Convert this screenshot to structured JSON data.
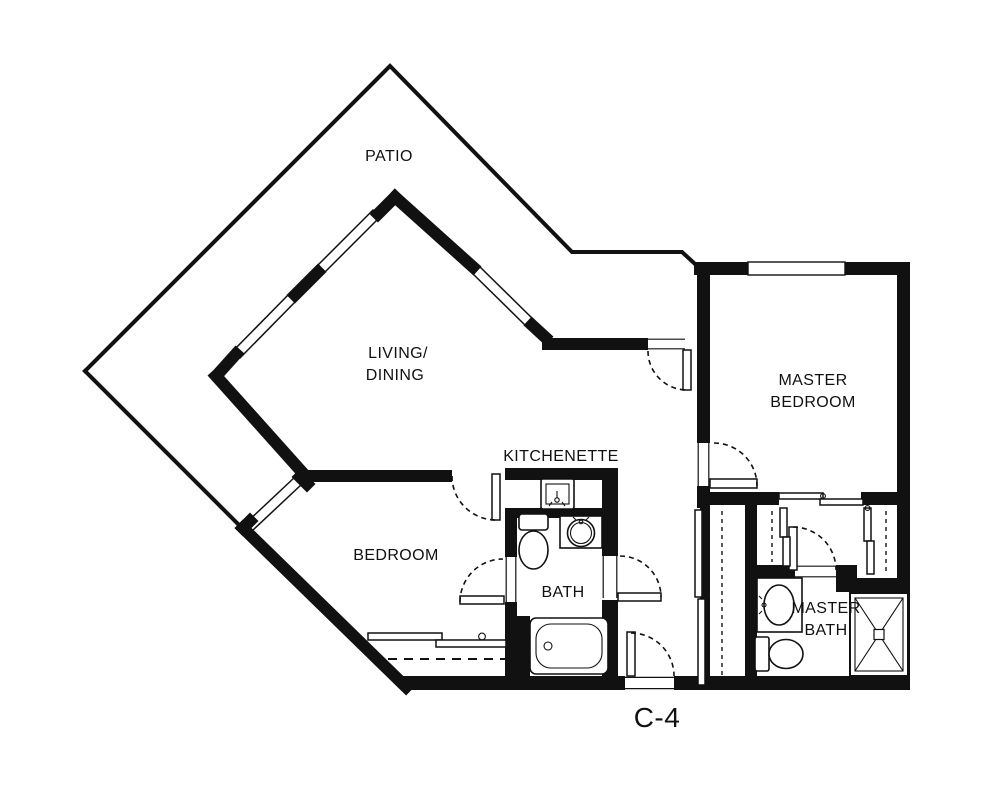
{
  "plan": {
    "code": "C-4",
    "rooms": {
      "patio": "PATIO",
      "living_line1": "LIVING/",
      "living_line2": "DINING",
      "kitchenette": "KITCHENETTE",
      "bedroom": "BEDROOM",
      "bath": "BATH",
      "master_bedroom_line1": "MASTER",
      "master_bedroom_line2": "BEDROOM",
      "master_bath_line1": "MASTER",
      "master_bath_line2": "BATH"
    },
    "colors": {
      "wall": "#111111",
      "background": "#ffffff",
      "text": "#111111"
    },
    "fixtures": [
      "kitchen-sink",
      "toilet",
      "vanity-sink",
      "bathtub",
      "master-vanity-sink",
      "master-toilet",
      "shower"
    ]
  }
}
